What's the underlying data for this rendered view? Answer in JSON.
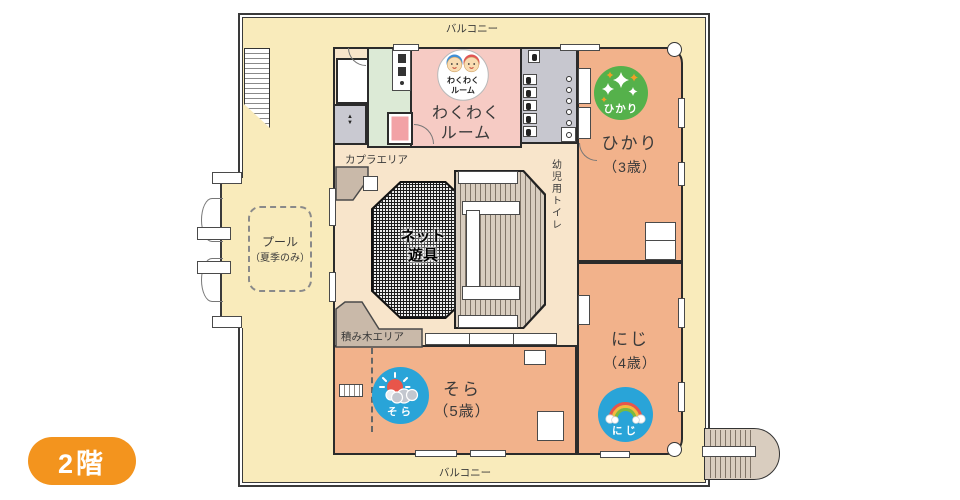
{
  "floor_badge": {
    "label": "2階",
    "color": "#f3941e"
  },
  "balcony": {
    "top": "バルコニー",
    "bottom": "バルコニー"
  },
  "areas": {
    "pool": {
      "line1": "プール",
      "line2": "（夏季のみ）"
    },
    "kapla": "カプラエリア",
    "tsumiki": "積み木エリア",
    "net": {
      "line1": "ネット",
      "line2": "遊具"
    },
    "toilet": "幼児用トイレ"
  },
  "rooms": {
    "wakuwaku": {
      "name_line1": "わくわく",
      "name_line2": "ルーム",
      "badge_line1": "わくわく",
      "badge_line2": "ルーム",
      "color": "#f6cbc4"
    },
    "hikari": {
      "name": "ひかり",
      "age": "（3歳）",
      "badge": "ひかり",
      "badge_color": "#55b14b",
      "color": "#f2b28b"
    },
    "niji": {
      "name": "にじ",
      "age": "（4歳）",
      "badge": "にじ",
      "badge_color": "#29a4d8",
      "color": "#f2b28b"
    },
    "sora": {
      "name": "そら",
      "age": "（5歳）",
      "badge": "そら",
      "badge_color": "#29a4d8",
      "color": "#f2b28b"
    }
  },
  "colors": {
    "balcony_fill": "#f9ebbb",
    "play_area_fill": "#f8e5cb",
    "toilet_fill": "#c7c7cf",
    "kitchen_fill": "#dcead6",
    "wood_area_fill": "#c9b9a9",
    "stair_fill": "#d8cdbf",
    "wall": "#2b2b2b",
    "sun": "#e8554a",
    "rainbow_orange": "#f6b93c",
    "rainbow_green": "#7cba3d"
  }
}
